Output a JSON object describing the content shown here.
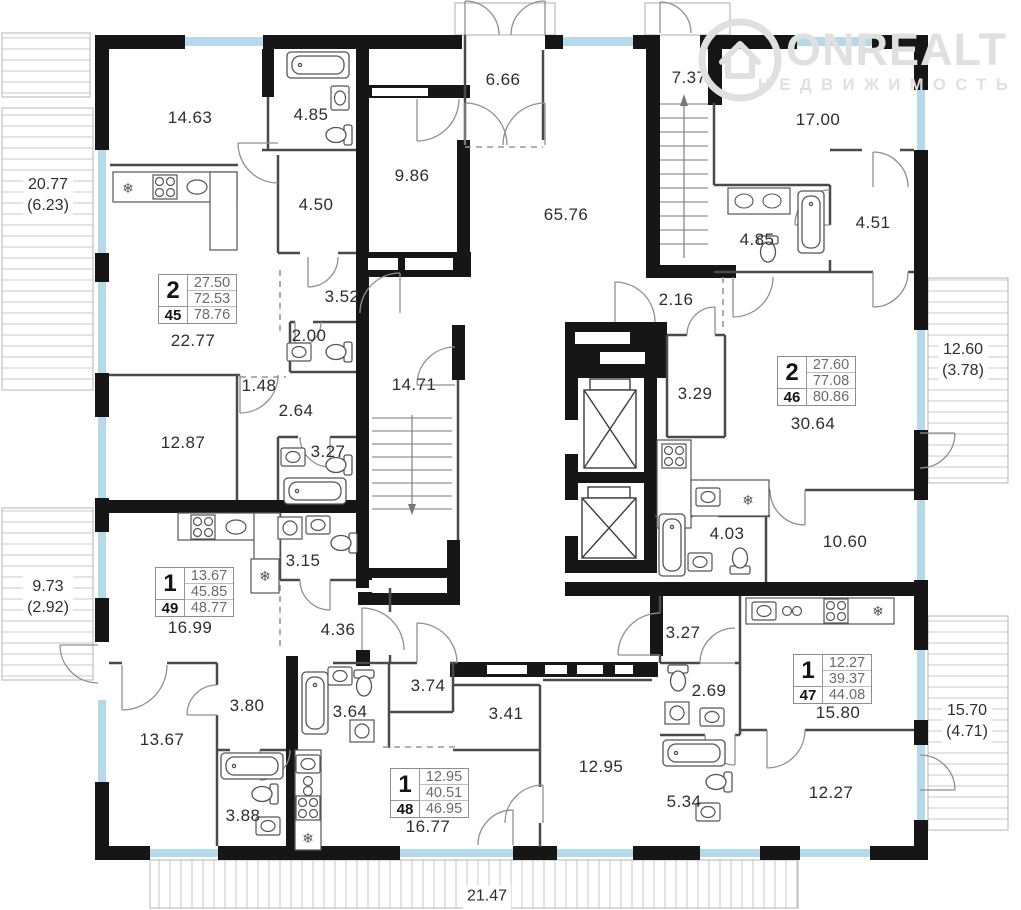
{
  "watermark": {
    "brand": "ONREALT",
    "tagline": "НЕДВИЖИМОСТЬ"
  },
  "apartments": [
    {
      "type": "2",
      "a1": "27.50",
      "a2": "72.53",
      "id": "45",
      "a3": "78.76"
    },
    {
      "type": "2",
      "a1": "27.60",
      "a2": "77.08",
      "id": "46",
      "a3": "80.86"
    },
    {
      "type": "1",
      "a1": "12.27",
      "a2": "39.37",
      "id": "47",
      "a3": "44.08"
    },
    {
      "type": "1",
      "a1": "12.95",
      "a2": "40.51",
      "id": "48",
      "a3": "46.95"
    },
    {
      "type": "1",
      "a1": "13.67",
      "a2": "45.85",
      "id": "49",
      "a3": "48.77"
    }
  ],
  "rooms": [
    "14.63",
    "4.85",
    "4.50",
    "9.86",
    "6.66",
    "65.76",
    "7.37",
    "17.00",
    "4.85",
    "4.51",
    "22.77",
    "3.52",
    "2.00",
    "1.48",
    "2.64",
    "12.87",
    "3.27",
    "14.71",
    "2.16",
    "3.29",
    "30.64",
    "4.03",
    "10.60",
    "16.99",
    "3.15",
    "4.36",
    "3.27",
    "13.67",
    "3.80",
    "3.64",
    "3.74",
    "3.41",
    "2.69",
    "12.95",
    "3.88",
    "5.34",
    "12.27",
    "16.77",
    "15.80"
  ],
  "balconies": [
    {
      "main": "20.77",
      "sub": "(6.23)"
    },
    {
      "main": "9.73",
      "sub": "(2.92)"
    },
    {
      "main": "12.60",
      "sub": "(3.78)"
    },
    {
      "main": "15.70",
      "sub": "(4.71)"
    },
    {
      "main": "21.47",
      "sub": ""
    }
  ],
  "icons": {
    "fridge": "❄"
  },
  "colors": {
    "wall": "#161616",
    "window": "#b5d9e8",
    "hatch": "#c9c9c9",
    "accent_text": "#2e2e2e"
  }
}
